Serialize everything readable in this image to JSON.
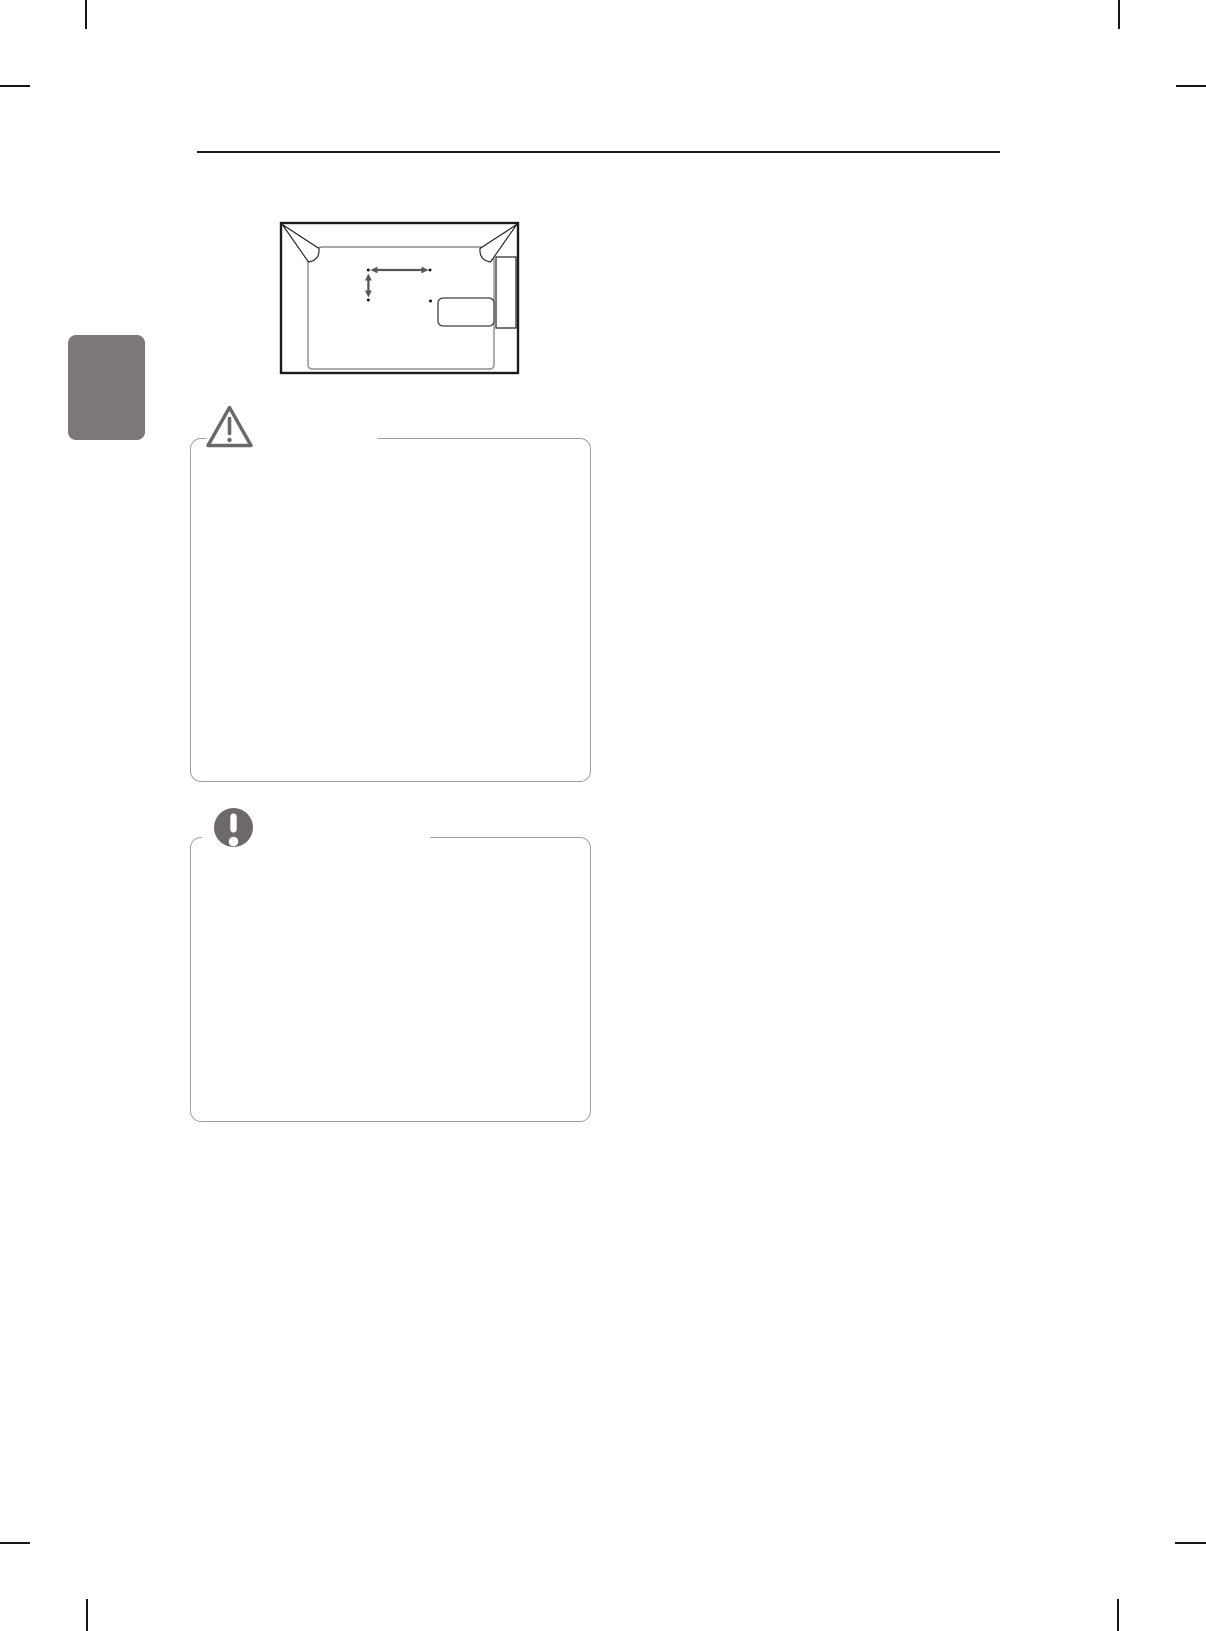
{
  "colors": {
    "page_background": "#ffffff",
    "crop_mark": "#161616",
    "header_rule": "#1f1f1f",
    "tab_gray": "#7d7878",
    "box_border": "#9d9d9d",
    "icon_gray": "#696969",
    "note_icon_gray": "#6e6969",
    "diagram_outline": "#1c1c1c",
    "diagram_inner": "#8b8b8b",
    "diagram_detail": "#3f3f3f",
    "arrow_gray": "#575757",
    "dot_black": "#1e1e1e"
  },
  "section_tab": {
    "label": ""
  },
  "diagram": {
    "name": "tv-rear-vesa-mounting-diagram",
    "mount_holes": 4,
    "arrows": [
      {
        "name": "vesa-width-arrow",
        "direction": "horizontal"
      },
      {
        "name": "vesa-height-arrow",
        "direction": "vertical"
      }
    ],
    "parts": [
      "tv-rear-outline",
      "back-panel",
      "vesa-mount-holes",
      "label-plate",
      "side-connector-panel"
    ]
  },
  "callout_boxes": [
    {
      "id": "caution-box",
      "icon": "warning-triangle-icon",
      "title": ""
    },
    {
      "id": "note-box",
      "icon": "exclamation-circle-icon",
      "title": ""
    }
  ]
}
